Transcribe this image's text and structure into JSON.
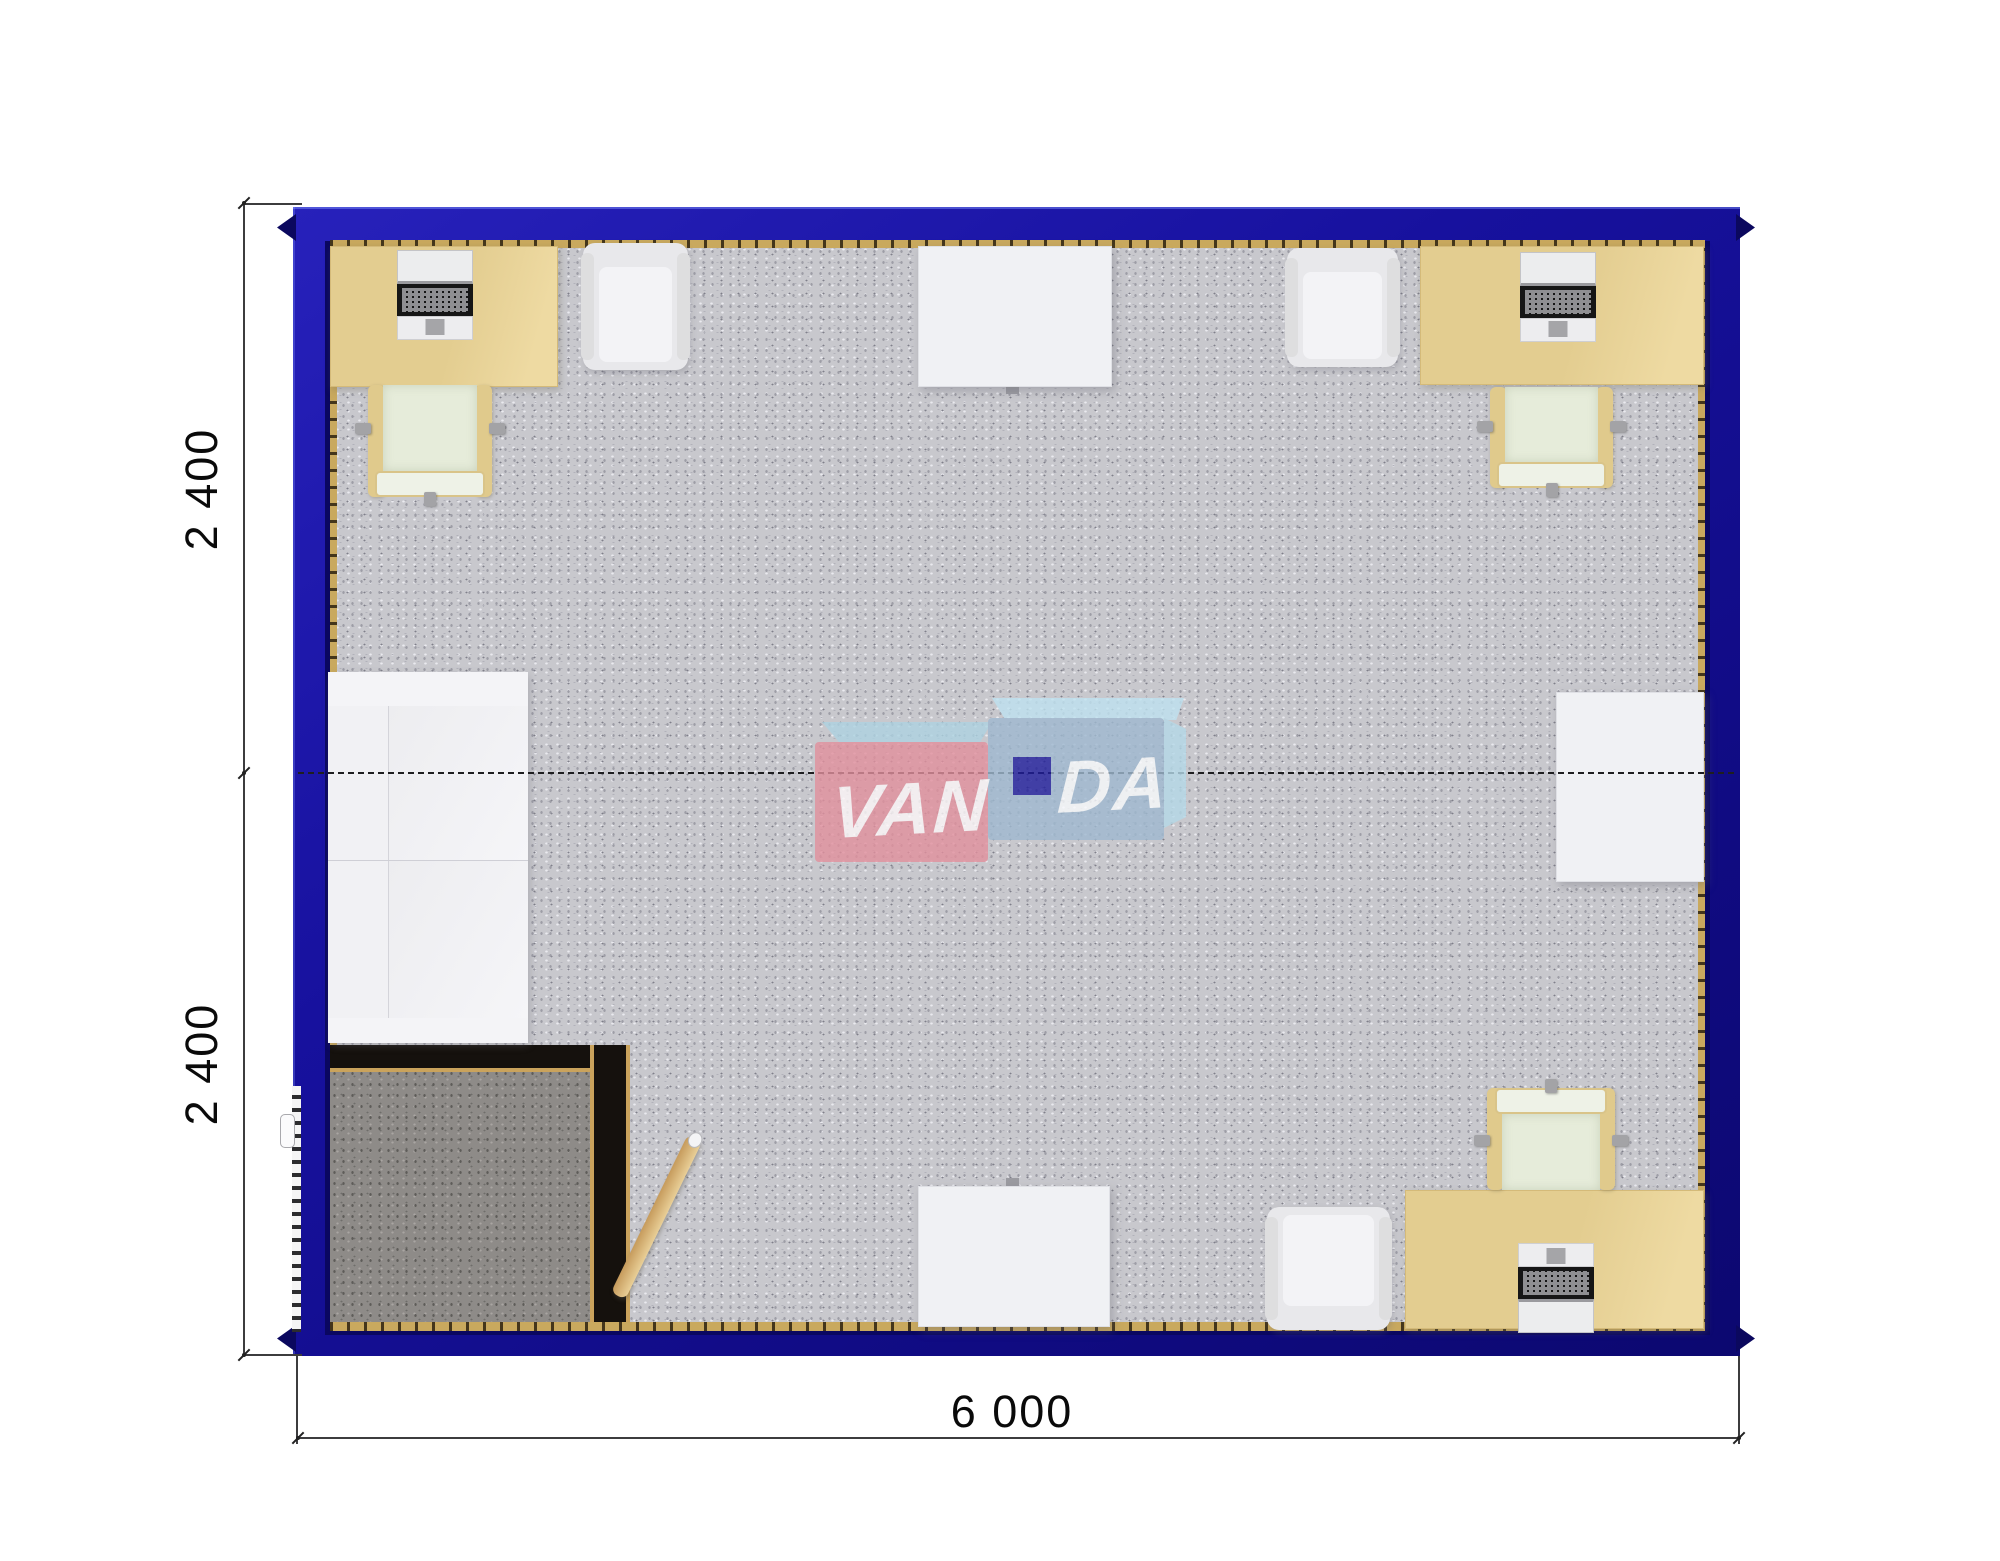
{
  "plan": {
    "title_watermark": {
      "left_text": "VAN",
      "right_text": "DA"
    },
    "dimensions": {
      "side_upper": "2 400",
      "side_lower": "2 400",
      "bottom": "6 000"
    },
    "colors": {
      "wall_blue": "#17119c",
      "wall_blue_dark": "#0c0870",
      "floor_carpet_gray": "#c8c8cd",
      "entry_mat_gray": "#8e8b88",
      "desk_tan": "#e3cd90",
      "wall_trim_tan": "#c9a95e",
      "chair_seat_green": "#e6ecda",
      "furniture_white": "#f0f1f4",
      "logo_pink": "#e2909d",
      "logo_blue": "#9fb9d0",
      "logo_sky": "#b5d9e8",
      "logo_square_blue": "#201d9c",
      "door_wood": "#d8b276",
      "vestibule_wall_black": "#15110d"
    },
    "furniture_inventory": [
      "desk-top-left",
      "laptop-top-left",
      "office-chair-top-left",
      "armchair-top-left",
      "table-top-center",
      "armchair-top-right",
      "desk-top-right",
      "laptop-top-right",
      "office-chair-top-right",
      "table-right-wall",
      "desk-bottom-right",
      "laptop-bottom-right",
      "office-chair-bottom-right",
      "armchair-bottom",
      "table-bottom-center",
      "sofa-left",
      "entry-vestibule-mat",
      "entry-door-leaf"
    ]
  }
}
